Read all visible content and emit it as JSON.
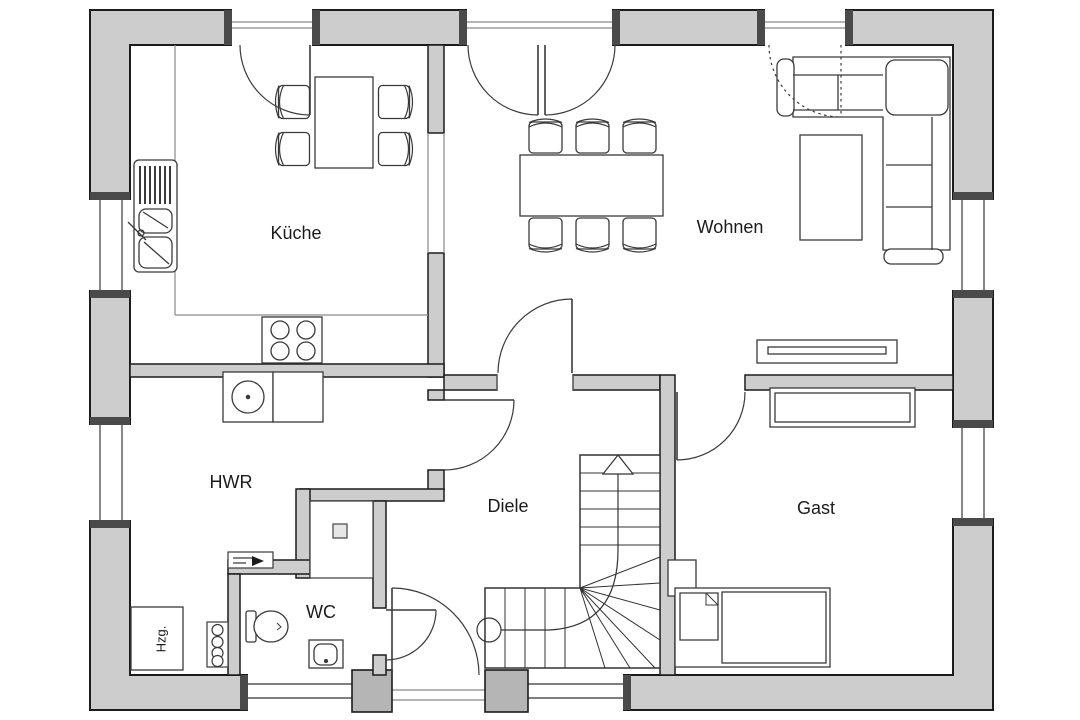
{
  "plan": {
    "type": "floor-plan",
    "rooms": {
      "kueche": {
        "label": "Küche"
      },
      "wohnen": {
        "label": "Wohnen"
      },
      "hwr": {
        "label": "HWR"
      },
      "diele": {
        "label": "Diele"
      },
      "wc": {
        "label": "WC"
      },
      "gast": {
        "label": "Gast"
      },
      "hzg": {
        "label": "Hzg."
      }
    },
    "colors": {
      "wall_fill": "#cdcdcd",
      "wall_outline": "#1c1c1c",
      "furniture_line": "#3a3a3a",
      "background": "#ffffff"
    }
  }
}
